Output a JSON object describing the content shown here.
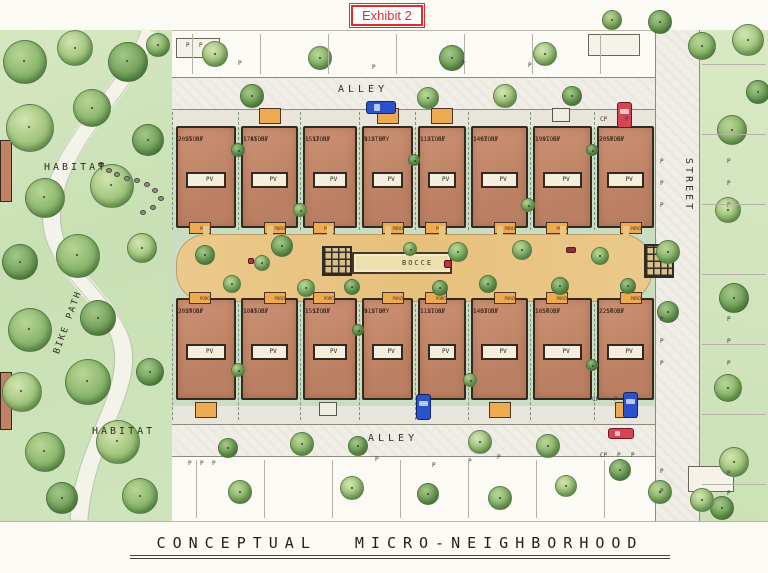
{
  "exhibit_label": "Exhibit 2",
  "title": "CONCEPTUAL MICRO-NEIGHBORHOOD",
  "labels": {
    "alley_top": "ALLEY",
    "alley_bottom": "ALLEY",
    "street": "STREET",
    "habitat_top": "HABITAT",
    "habitat_bottom": "HABITAT",
    "bike_path": "BIKE PATH",
    "bocce": "BOCCE",
    "pv": "PV",
    "porch": "PORCH",
    "parking": "P",
    "carport": "CP"
  },
  "houses": {
    "top_row": [
      {
        "stories": "2 STORY",
        "area": "2025 SF"
      },
      {
        "stories": "1 STORY",
        "area": "1745 SF"
      },
      {
        "stories": "1 STORY",
        "area": "1512 SF"
      },
      {
        "stories": "1 STORY",
        "area": "912 SF"
      },
      {
        "stories": "1 STORY",
        "area": "1121 SF"
      },
      {
        "stories": "1 STORY",
        "area": "1402 SF"
      },
      {
        "stories": "1 STORY",
        "area": "1991 SF"
      },
      {
        "stories": "2 STORY",
        "area": "2050 SF"
      }
    ],
    "bottom_row": [
      {
        "stories": "2 STORY",
        "area": "2029 SF"
      },
      {
        "stories": "1 STORY",
        "area": "1845 SF"
      },
      {
        "stories": "1 STORY",
        "area": "1512 SF"
      },
      {
        "stories": "1 STORY",
        "area": "912 SF"
      },
      {
        "stories": "1 STORY",
        "area": "1121 SF"
      },
      {
        "stories": "1 STORY",
        "area": "1403 SF"
      },
      {
        "stories": "1 STORY",
        "area": "1850 SF"
      },
      {
        "stories": "2 STORY",
        "area": "2250 SF"
      }
    ]
  },
  "colors": {
    "exhibit_red": "#e22c2c",
    "house": "#c2876a",
    "house_border": "#35281e",
    "pv_panel": "#f3eedd",
    "porch_orange": "#eeaa4e",
    "courtyard_tan": "#e9c583",
    "bocce_court": "#eedfae",
    "habitat_green": "#cfe4bc",
    "canopy_green": "#86b369",
    "pavement": "#ece9e2",
    "block_green": "#c9ddc4",
    "car_blue": "#2a52cc",
    "car_red": "#d64554",
    "ink": "#2e2a24"
  }
}
